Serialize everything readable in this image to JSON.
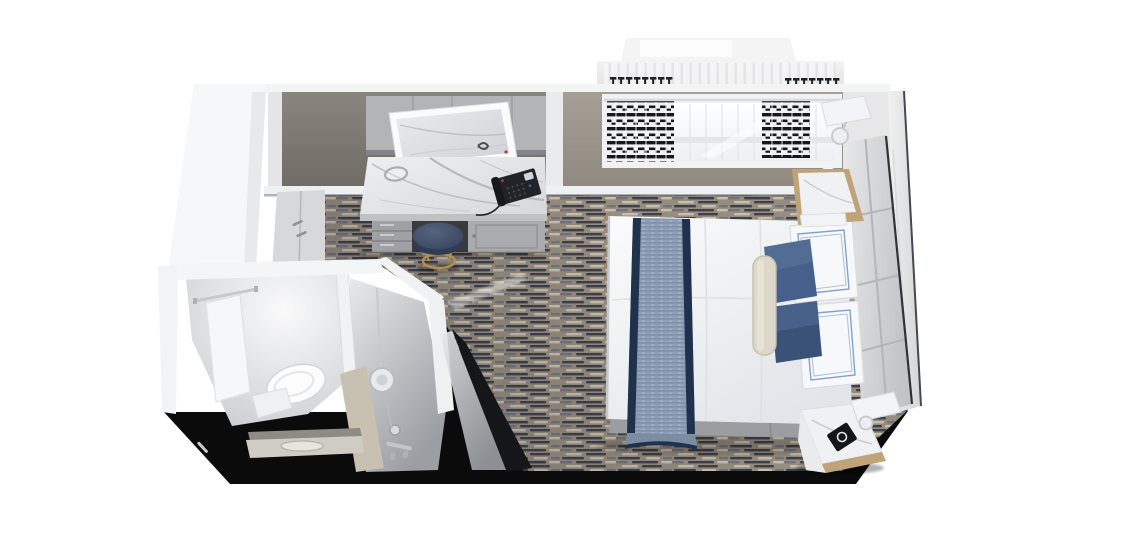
{
  "scene": {
    "kind": "3d-cutaway-floorplan-render",
    "subject": "oceanview-stateroom",
    "areas": [
      "entry",
      "bathroom",
      "vanity-desk",
      "wardrobe",
      "bedroom",
      "window-bay"
    ],
    "objects": [
      {
        "name": "wardrobe-closet",
        "label": "closet with double doors"
      },
      {
        "name": "vanity-desk",
        "label": "marble-top vanity desk with drawers"
      },
      {
        "name": "vanity-mirror",
        "label": "framed wall mirror"
      },
      {
        "name": "telephone",
        "label": "black desk telephone"
      },
      {
        "name": "magnifying-mirror",
        "label": "round tabletop mirror"
      },
      {
        "name": "stool",
        "label": "round navy stool with brass legs"
      },
      {
        "name": "bed",
        "label": "queen bed with white duvet"
      },
      {
        "name": "bed-runner",
        "label": "blue chambray bed runner"
      },
      {
        "name": "pillows",
        "label": "white embroidered and navy velvet pillows with bolster"
      },
      {
        "name": "headboard",
        "label": "quilted panel headboard"
      },
      {
        "name": "nightstand-upper",
        "label": "marble-top nightstand"
      },
      {
        "name": "nightstand-lower",
        "label": "marble-top nightstand"
      },
      {
        "name": "wall-sconce-upper",
        "label": "wall sconce"
      },
      {
        "name": "wall-sconce-lower",
        "label": "wall sconce"
      },
      {
        "name": "window-bay",
        "label": "picture window with drapes"
      },
      {
        "name": "curtains",
        "label": "black and white patterned drapes"
      },
      {
        "name": "toilet",
        "label": "toilet"
      },
      {
        "name": "shower",
        "label": "shower with rain head and glass door"
      },
      {
        "name": "vanity-sink",
        "label": "bathroom vanity sink"
      },
      {
        "name": "carpet",
        "label": "patterned carpet"
      }
    ]
  },
  "colors": {
    "background": "#ffffff",
    "base_black": "#0b0b0c",
    "carpet_base": "#968c7f",
    "carpet_dark": "#39404f",
    "carpet_mid": "#6e7482",
    "carpet_light": "#c9beac",
    "wall_alcove": "#7d7871",
    "wall_window": "#9d978d",
    "wall_right_section": "#e7e7e8",
    "wall_white": "#f6f7f8",
    "wall_top_strip": "#f3f4f4",
    "baseboard": "#eef0f2",
    "closet_door": "#d6d8da",
    "overhead_cabinet": "#b2b4b6",
    "marble": "#e9eaeb",
    "marble_vein": "#b7bac0",
    "desk_body": "#a9abae",
    "drawer_metal": "#9fa2a5",
    "knee_dark": "#3a3b3e",
    "stool_top": "#47556d",
    "stool_side": "#2f3c54",
    "brass": "#b3904f",
    "phone_body": "#212326",
    "phone_screen": "#cdd6dd",
    "phone_light": "#c0392b",
    "duvet": "#f5f6f8",
    "bed_base": "#9b9da0",
    "runner_blue": "#8fa0b8",
    "runner_navy": "#20314e",
    "pillow_navy": "#45608a",
    "pillow_white": "#f7f8fa",
    "pillow_trim": "#85a3c7",
    "bolster": "#ddd8ca",
    "headboard_panel": "#dcdee0",
    "headboard_seam": "#b3b6b9",
    "wood_trim": "#c0a379",
    "nightstand_marble": "#eff1f2",
    "curtain_black": "#17181b",
    "curtain_white": "#f1f1f2",
    "window_glow": "#fbfcfe",
    "window_frame": "#f1f2f3",
    "mullion": "#dde1e5",
    "exterior_band": "#ebebec",
    "overhang": "#f4f4f5",
    "sconce_white": "#f3f4f6",
    "chrome": "#c3c7cb",
    "bath_wall": "#f4f5f6",
    "bath_floor": "#e7e8ea",
    "shower_floor": "#c7c9cc",
    "beige_panel": "#c8c0b1",
    "glass_dark": "#15161a",
    "toilet_white": "#fcfcfd",
    "vanity_slab": "#cfccc3"
  }
}
